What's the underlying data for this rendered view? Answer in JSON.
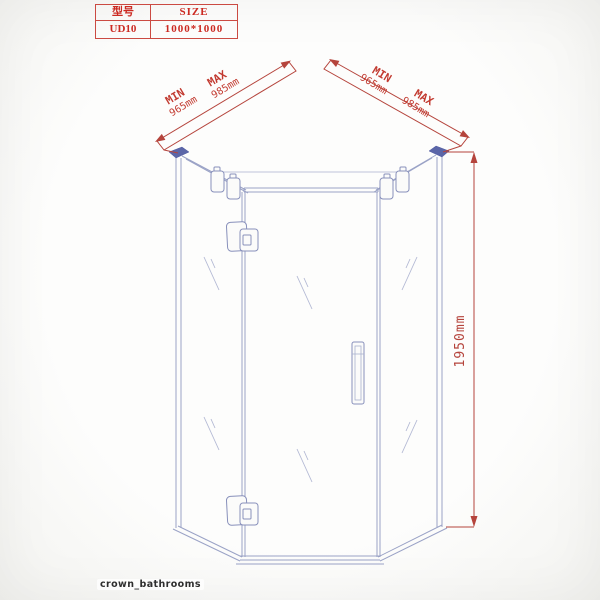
{
  "spec_table": {
    "col1_header": "型号",
    "col2_header": "SIZE",
    "model": "UD10",
    "size": "1000*1000"
  },
  "dimensions": {
    "left_wall": {
      "min_label": "MIN",
      "min_value": "965mm",
      "max_label": "MAX",
      "max_value": "985mm"
    },
    "right_wall": {
      "min_label": "MIN",
      "min_value": "965mm",
      "max_label": "MAX",
      "max_value": "985mm"
    },
    "height": {
      "value": "1950mm"
    }
  },
  "watermark": {
    "text": "crown_bathrooms"
  },
  "colors": {
    "dimension_red": "#b5443c",
    "table_red": "#cc2a22",
    "drawing_line_blue": "#9aa2c6",
    "corner_cap_navy": "#5b66a8",
    "watermark_gray": "#2f2f2f",
    "background": "#fbfbfa"
  }
}
